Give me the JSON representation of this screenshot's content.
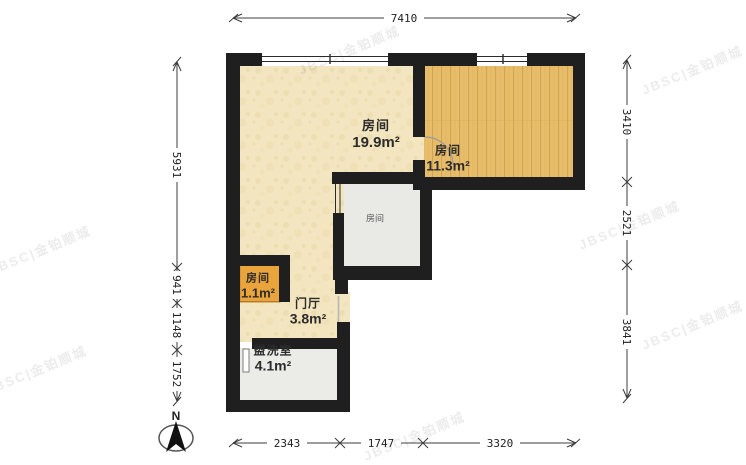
{
  "rooms": {
    "bedroom_large": {
      "name": "房间",
      "area": "19.9m²"
    },
    "bedroom_wood": {
      "name": "房间",
      "area": "11.3m²"
    },
    "inner": {
      "name": "房间"
    },
    "closet": {
      "name": "房间",
      "area": "1.1m²"
    },
    "hall": {
      "name": "门厅",
      "area": "3.8m²"
    },
    "washroom": {
      "name": "盥洗室",
      "area": "4.1m²"
    }
  },
  "dimensions_mm": {
    "top": [
      "7410"
    ],
    "left": [
      "5931",
      "941",
      "1148",
      "1752"
    ],
    "right": [
      "3410",
      "2521",
      "3841"
    ],
    "bottom": [
      "2343",
      "1747",
      "3320"
    ]
  },
  "compass": {
    "north_label": "N"
  },
  "watermark": {
    "text": "JBSC|金铂顺城"
  },
  "colors": {
    "wall": "#1f1f1f",
    "floor_cream": "#f2e5bf",
    "floor_wood": "#e7bd6b",
    "floor_gray": "#e9e9e6",
    "floor_washroom": "#ebebe8",
    "floor_orange": "#e9a43c",
    "dimension_line": "#3c3c3c"
  }
}
